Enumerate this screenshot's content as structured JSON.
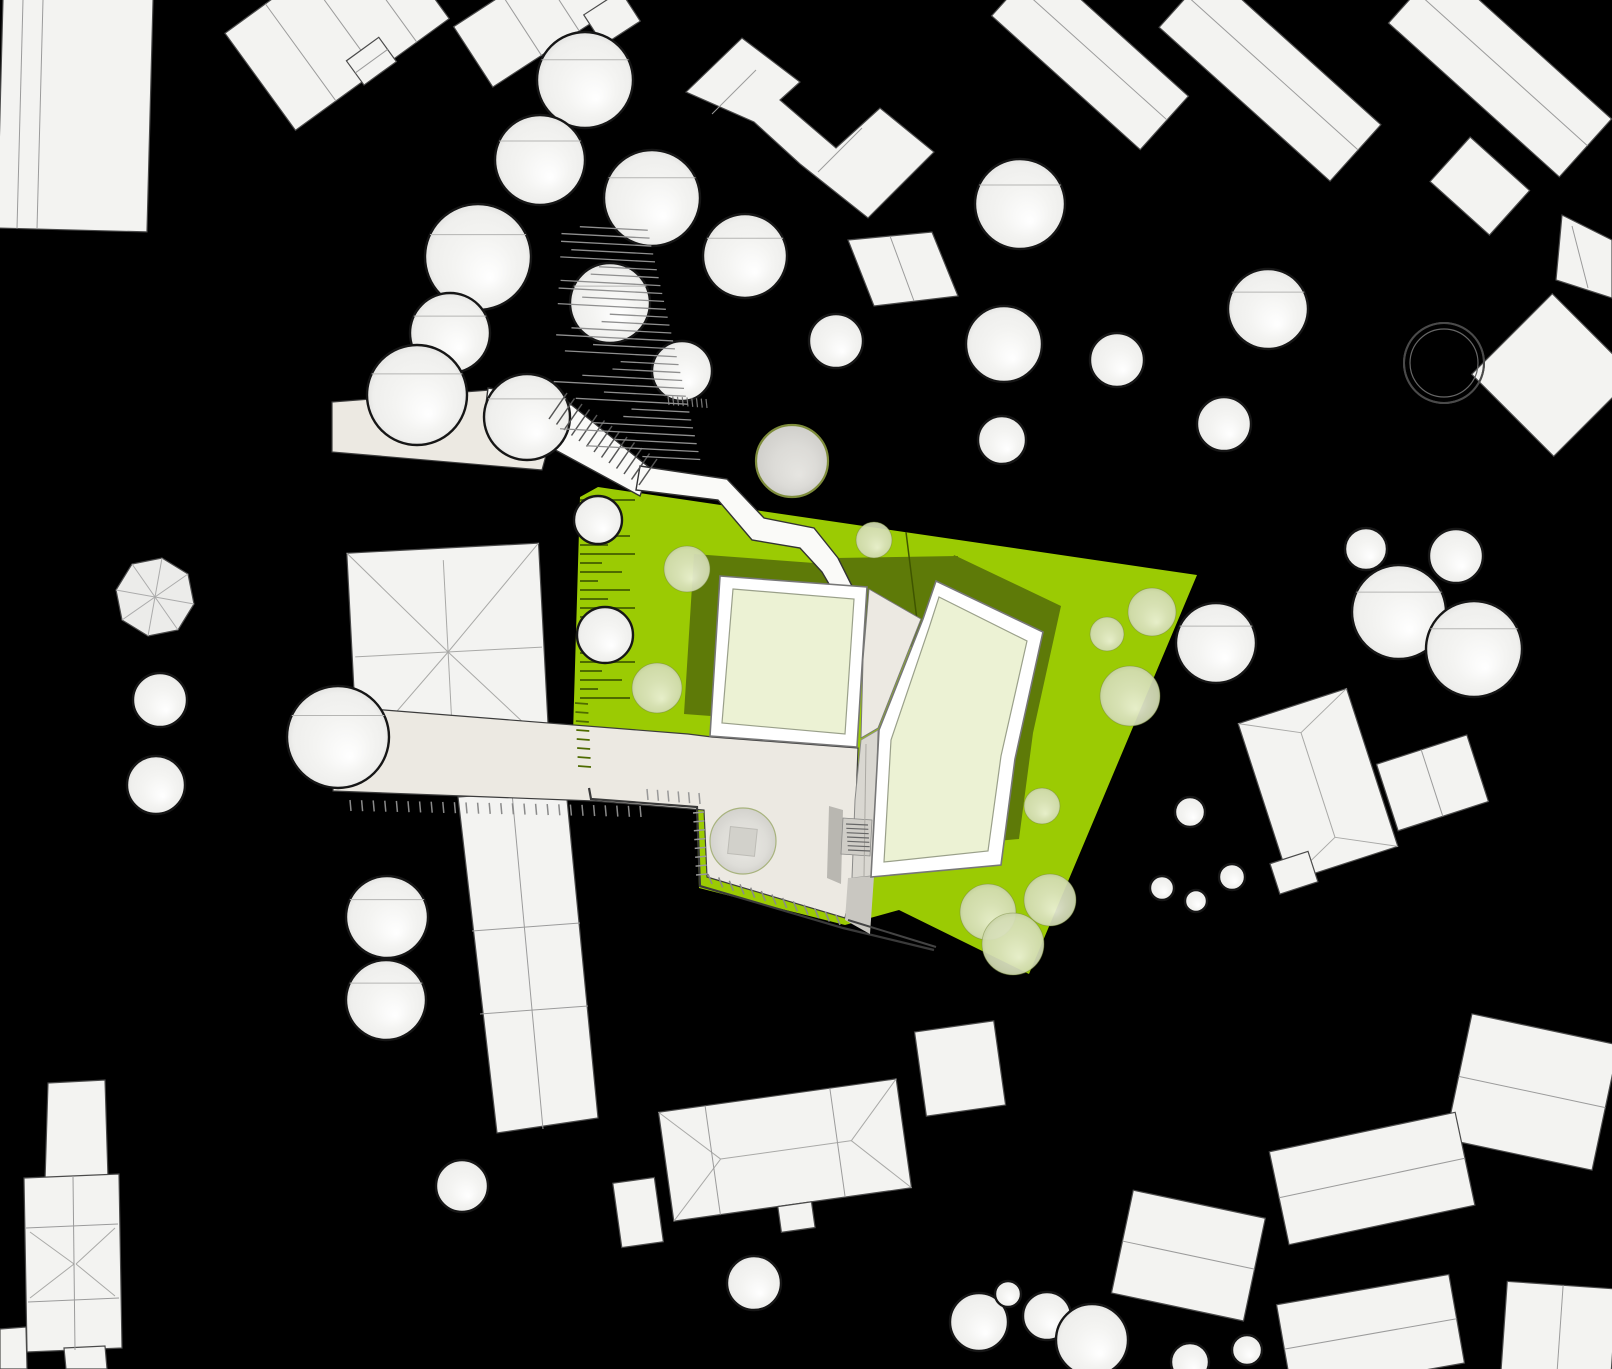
{
  "palette": {
    "bg": "#000000",
    "building_fill": "#F3F3F1",
    "building_fill_alt": "#ECECEA",
    "building_stroke": "#4A4A4A",
    "seam": "#9B9B9B",
    "site_green": "#9BCB03",
    "shadow_olive": "#5E7A08",
    "courtyard": "#ECF2D4",
    "roof_frame": "#FFFFFF",
    "roof_stroke": "#777777",
    "path_beige": "#ECE9E2",
    "path_white": "#FAFAF8",
    "walkway_gray": "#D9D7D1",
    "ramp_gray": "#B9B7B1",
    "stair_gray": "#CFCDC7",
    "lower_gray": "#C9C7C1",
    "tree_white": "#F2F2F0",
    "tree_pale": "#D9E0BD",
    "tree_gray": "#DCDBD7",
    "tree_white_stroke": "#161616",
    "tree_pale_stroke": "#74853A",
    "tree_gray_stroke": "#7E8C3B",
    "ring_stroke": "#4A4A4A",
    "hatch_gray": "#8A8A8A",
    "hatch_olive": "#4E6B00",
    "wall_line": "#3A3A3A",
    "chord": "#B5B5B3"
  },
  "scene": {
    "chord_angles": [
      205,
      335
    ],
    "trees": [
      [
        585,
        80,
        48,
        "w"
      ],
      [
        540,
        160,
        45,
        "w"
      ],
      [
        652,
        198,
        48,
        "w"
      ],
      [
        478,
        257,
        53,
        "w"
      ],
      [
        450,
        333,
        40,
        "w"
      ],
      [
        417,
        395,
        50,
        "w"
      ],
      [
        527,
        417,
        43,
        "w"
      ],
      [
        610,
        303,
        40,
        "w"
      ],
      [
        682,
        371,
        30,
        "w"
      ],
      [
        745,
        256,
        42,
        "w"
      ],
      [
        836,
        341,
        27,
        "w"
      ],
      [
        1020,
        204,
        45,
        "w"
      ],
      [
        1004,
        344,
        38,
        "w"
      ],
      [
        1117,
        360,
        27,
        "w"
      ],
      [
        1002,
        440,
        24,
        "w"
      ],
      [
        1268,
        309,
        40,
        "w"
      ],
      [
        1224,
        424,
        27,
        "w"
      ],
      [
        1366,
        549,
        21,
        "w"
      ],
      [
        1456,
        556,
        27,
        "w"
      ],
      [
        1399,
        612,
        47,
        "w"
      ],
      [
        1474,
        649,
        48,
        "w"
      ],
      [
        160,
        700,
        27,
        "w"
      ],
      [
        156,
        785,
        29,
        "w"
      ],
      [
        338,
        737,
        51,
        "w"
      ],
      [
        387,
        917,
        41,
        "w"
      ],
      [
        386,
        1000,
        40,
        "w"
      ],
      [
        462,
        1186,
        26,
        "w"
      ],
      [
        754,
        1283,
        27,
        "w"
      ],
      [
        979,
        1322,
        29,
        "w"
      ],
      [
        1008,
        1294,
        13,
        "w"
      ],
      [
        1047,
        1316,
        24,
        "w"
      ],
      [
        1092,
        1340,
        36,
        "w"
      ],
      [
        1190,
        812,
        15,
        "w"
      ],
      [
        1232,
        877,
        13,
        "w"
      ],
      [
        1162,
        888,
        12,
        "w"
      ],
      [
        1196,
        901,
        11,
        "w"
      ],
      [
        1247,
        1350,
        15,
        "w"
      ],
      [
        1190,
        1362,
        19,
        "w"
      ],
      [
        598,
        520,
        24,
        "w"
      ],
      [
        605,
        635,
        28,
        "w"
      ],
      [
        1216,
        643,
        40,
        "w"
      ],
      [
        687,
        569,
        23,
        "p"
      ],
      [
        657,
        688,
        25,
        "p"
      ],
      [
        874,
        540,
        18,
        "p"
      ],
      [
        1107,
        634,
        17,
        "p"
      ],
      [
        1130,
        696,
        30,
        "p"
      ],
      [
        1050,
        900,
        26,
        "p"
      ],
      [
        988,
        912,
        28,
        "p"
      ],
      [
        1013,
        944,
        31,
        "p"
      ],
      [
        1042,
        806,
        18,
        "p"
      ],
      [
        1152,
        612,
        24,
        "p"
      ],
      [
        792,
        461,
        36,
        "g"
      ],
      [
        1444,
        363,
        40,
        "r"
      ],
      [
        743,
        841,
        33,
        "z"
      ]
    ],
    "tick_rows": [
      {
        "ax": 350,
        "ay": 800,
        "bx": 640,
        "by": 806,
        "n": 26,
        "vx": 1,
        "vy": 11,
        "c": "#8A8A8A",
        "w": 1.5
      },
      {
        "ax": 648,
        "ay": 800,
        "bx": 700,
        "by": 804,
        "n": 6,
        "vx": -1,
        "vy": -11,
        "c": "#999999",
        "w": 1.5
      },
      {
        "ax": 704,
        "ay": 812,
        "bx": 707,
        "by": 874,
        "n": 8,
        "vx": -11,
        "vy": 1,
        "c": "#999999",
        "w": 1.5
      },
      {
        "ax": 712,
        "ay": 884,
        "bx": 840,
        "by": 925,
        "n": 13,
        "vx": -4,
        "vy": -10,
        "c": "#8A8A8A",
        "w": 1.5
      },
      {
        "ax": 575,
        "ay": 703,
        "bx": 578,
        "by": 766,
        "n": 8,
        "vx": 13,
        "vy": 1,
        "c": "#4E6B00",
        "w": 1.8
      },
      {
        "ax": 549,
        "ay": 419,
        "bx": 639,
        "by": 485,
        "n": 13,
        "vx": 18,
        "vy": -26,
        "c": "#555555",
        "w": 1.5
      },
      {
        "ax": 846,
        "ay": 824,
        "bx": 848,
        "by": 850,
        "n": 7,
        "vx": 22,
        "vy": 1,
        "c": "#666666",
        "w": 1.2
      },
      {
        "ax": 668,
        "ay": 396,
        "bx": 706,
        "by": 399,
        "n": 9,
        "vx": 1,
        "vy": 9,
        "c": "#777777",
        "w": 1.2
      }
    ],
    "hlines": {
      "x": 580,
      "y0": 500,
      "dy": 9,
      "n": 23,
      "lens": [
        55,
        22,
        42,
        18,
        50,
        28
      ],
      "c": "#4E6B00",
      "w": 2
    },
    "fan": {
      "n": 30,
      "y0": 230,
      "dy": 7.8,
      "xr0": 642,
      "slope": 0.285,
      "lens": [
        68,
        100,
        135,
        82,
        112,
        58
      ],
      "rot": 3,
      "cx": 640,
      "cy": 340,
      "c": "#8F8F8F",
      "w": 1.3
    }
  }
}
